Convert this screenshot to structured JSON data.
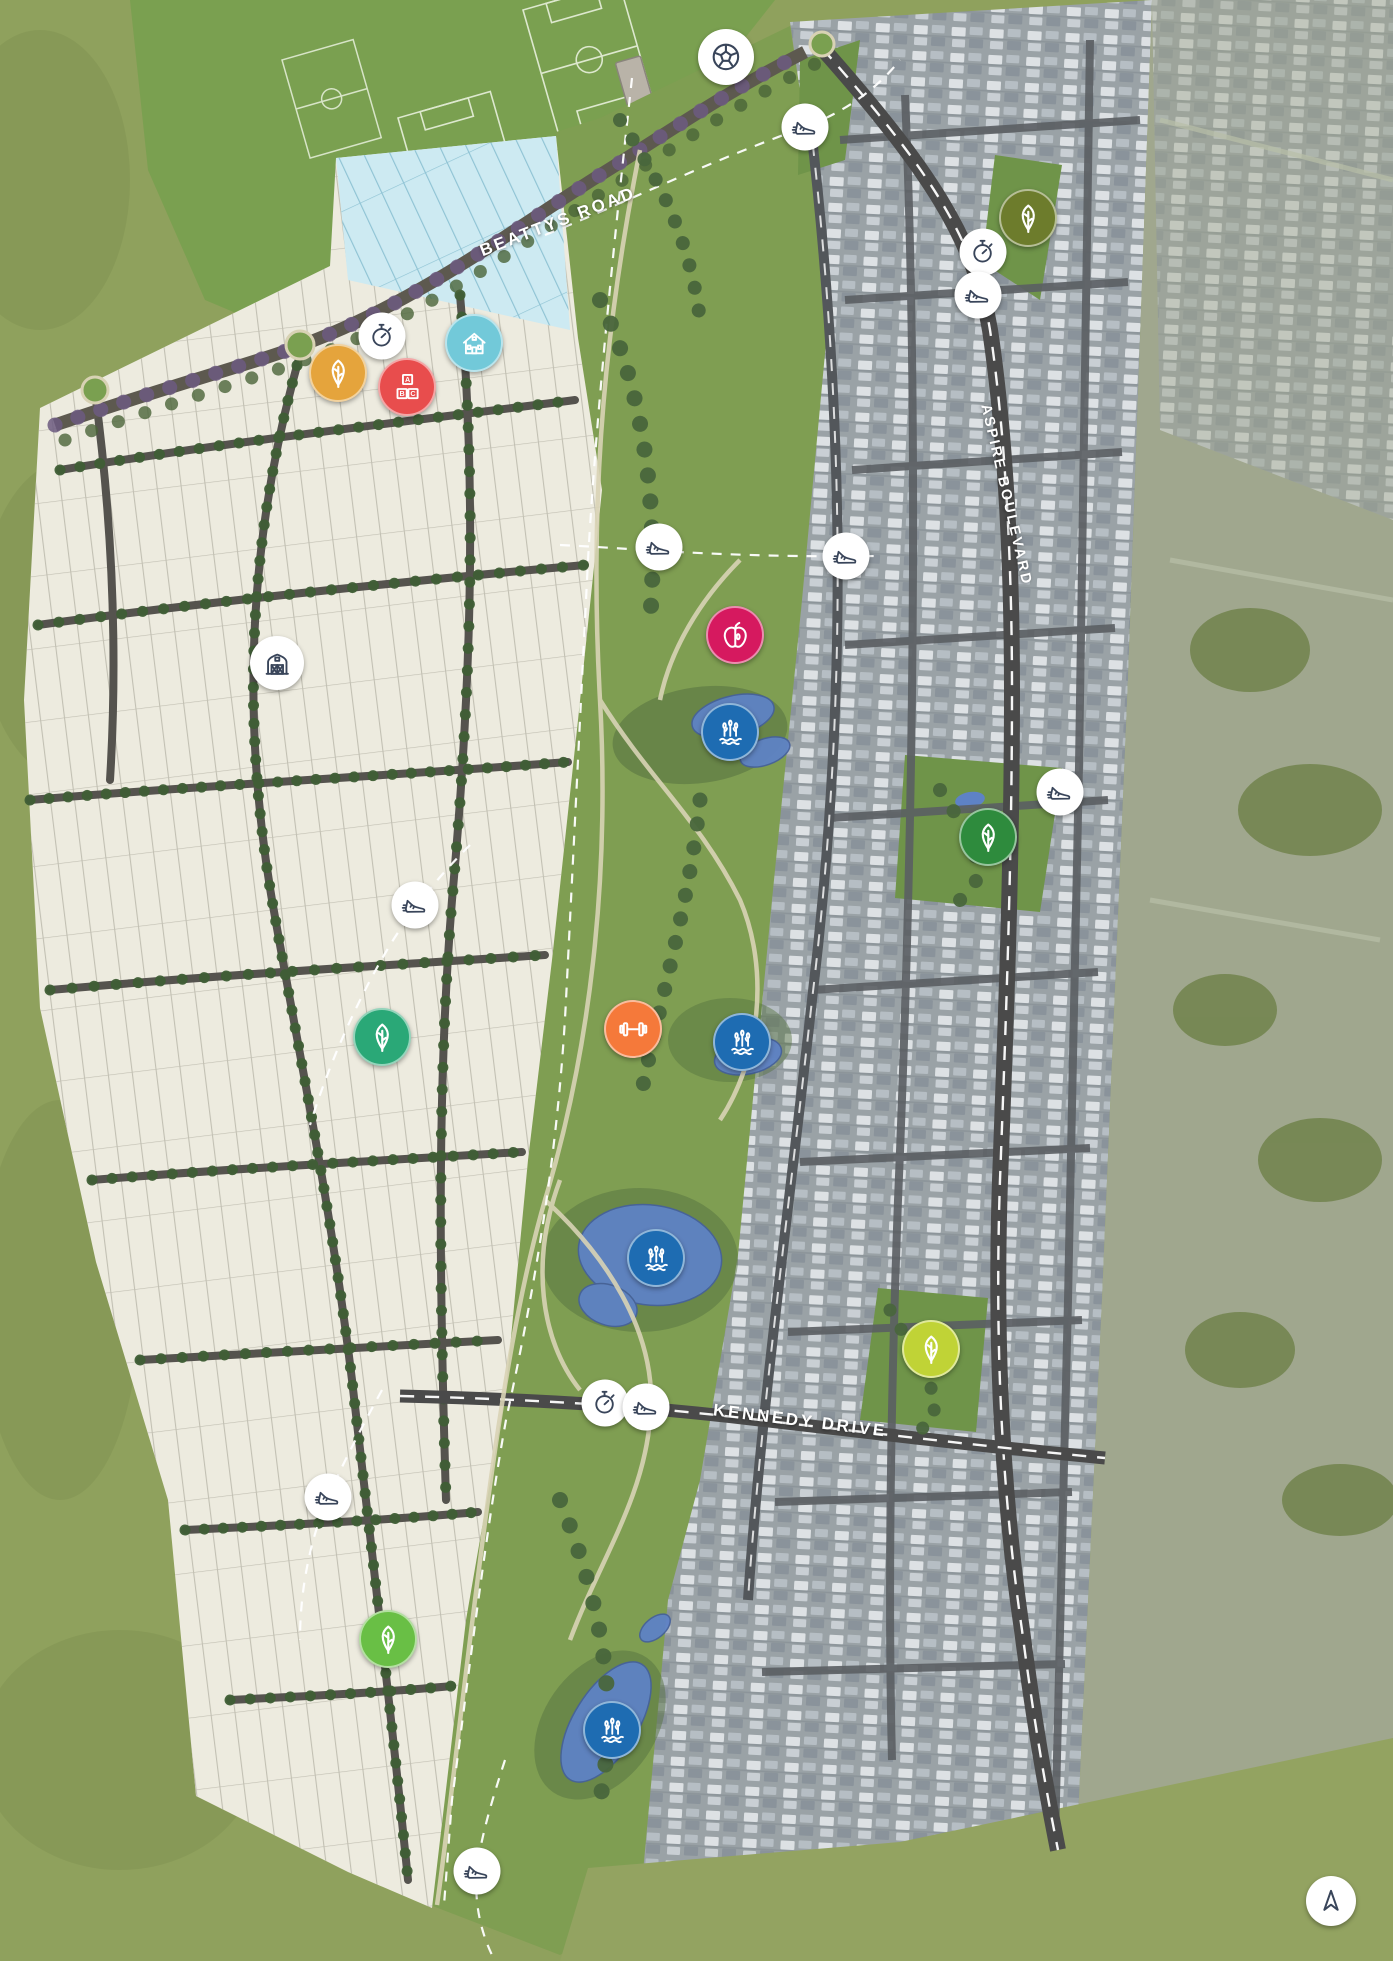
{
  "map": {
    "title": "Estate masterplan aerial map",
    "roads": [
      {
        "id": "beattys-road",
        "label": "BEATTYS ROAD"
      },
      {
        "id": "aspire-boulevard",
        "label": "ASPIRE BOULEVARD"
      },
      {
        "id": "kennedy-drive",
        "label": "KENNEDY DRIVE"
      }
    ],
    "colors": {
      "field_green": "#8fa15d",
      "parkland_green": "#7aa050",
      "corridor_green": "#7f9e52",
      "lot_white": "#edebdf",
      "display_lot_blue": "#cdeaf2",
      "pond_blue": "#5e82c6",
      "road_dark": "#4a4a4a",
      "marker_amber": "#e5a43c",
      "marker_red": "#e84d4d",
      "marker_teal_house": "#72c9d9",
      "marker_magenta": "#d6195f",
      "marker_wetland_blue": "#1e6cb2",
      "marker_orange": "#f5793a",
      "marker_olive": "#6d7c2c",
      "marker_green": "#2e8b3d",
      "marker_teal_leaf": "#2aa877",
      "marker_lime": "#c0d336",
      "marker_bright_green": "#69bf45",
      "marker_white": "#ffffff",
      "marker_glyph_dark": "#39455a"
    },
    "markers": [
      {
        "type": "soccer-ball",
        "x": 726,
        "y": 57,
        "size": 56,
        "bg": "#ffffff",
        "fg": "#39455a"
      },
      {
        "type": "running-shoe",
        "x": 805,
        "y": 127,
        "size": 47,
        "bg": "#ffffff",
        "fg": "#39455a"
      },
      {
        "type": "leaf",
        "x": 1028,
        "y": 218,
        "size": 54,
        "bg": "#6d7c2c",
        "fg": "#ffffff"
      },
      {
        "type": "stopwatch",
        "x": 983,
        "y": 252,
        "size": 47,
        "bg": "#ffffff",
        "fg": "#39455a"
      },
      {
        "type": "running-shoe",
        "x": 978,
        "y": 295,
        "size": 47,
        "bg": "#ffffff",
        "fg": "#39455a"
      },
      {
        "type": "stopwatch",
        "x": 382,
        "y": 336,
        "size": 47,
        "bg": "#ffffff",
        "fg": "#39455a"
      },
      {
        "type": "leaf",
        "x": 338,
        "y": 373,
        "size": 54,
        "bg": "#e5a43c",
        "fg": "#ffffff"
      },
      {
        "type": "house",
        "x": 474,
        "y": 343,
        "size": 54,
        "bg": "#72c9d9",
        "fg": "#ffffff"
      },
      {
        "type": "abc-blocks",
        "x": 407,
        "y": 387,
        "size": 54,
        "bg": "#e84d4d",
        "fg": "#ffffff"
      },
      {
        "type": "barn",
        "x": 277,
        "y": 663,
        "size": 54,
        "bg": "#ffffff",
        "fg": "#39455a"
      },
      {
        "type": "running-shoe",
        "x": 659,
        "y": 547,
        "size": 47,
        "bg": "#ffffff",
        "fg": "#39455a"
      },
      {
        "type": "running-shoe",
        "x": 846,
        "y": 556,
        "size": 47,
        "bg": "#ffffff",
        "fg": "#39455a"
      },
      {
        "type": "apple",
        "x": 735,
        "y": 635,
        "size": 54,
        "bg": "#d6195f",
        "fg": "#ffffff"
      },
      {
        "type": "wetland-reeds",
        "x": 730,
        "y": 732,
        "size": 54,
        "bg": "#1e6cb2",
        "fg": "#ffffff"
      },
      {
        "type": "running-shoe",
        "x": 1060,
        "y": 792,
        "size": 47,
        "bg": "#ffffff",
        "fg": "#39455a"
      },
      {
        "type": "leaf",
        "x": 988,
        "y": 837,
        "size": 54,
        "bg": "#2e8b3d",
        "fg": "#ffffff"
      },
      {
        "type": "running-shoe",
        "x": 415,
        "y": 905,
        "size": 47,
        "bg": "#ffffff",
        "fg": "#39455a"
      },
      {
        "type": "leaf",
        "x": 382,
        "y": 1037,
        "size": 54,
        "bg": "#2aa877",
        "fg": "#ffffff"
      },
      {
        "type": "dumbbell",
        "x": 633,
        "y": 1029,
        "size": 54,
        "bg": "#f5793a",
        "fg": "#ffffff"
      },
      {
        "type": "wetland-reeds",
        "x": 742,
        "y": 1042,
        "size": 54,
        "bg": "#1e6cb2",
        "fg": "#ffffff"
      },
      {
        "type": "wetland-reeds",
        "x": 656,
        "y": 1258,
        "size": 54,
        "bg": "#1e6cb2",
        "fg": "#ffffff"
      },
      {
        "type": "leaf",
        "x": 931,
        "y": 1349,
        "size": 54,
        "bg": "#c0d336",
        "fg": "#ffffff"
      },
      {
        "type": "stopwatch",
        "x": 605,
        "y": 1403,
        "size": 47,
        "bg": "#ffffff",
        "fg": "#39455a"
      },
      {
        "type": "running-shoe",
        "x": 646,
        "y": 1407,
        "size": 47,
        "bg": "#ffffff",
        "fg": "#39455a"
      },
      {
        "type": "running-shoe",
        "x": 328,
        "y": 1497,
        "size": 47,
        "bg": "#ffffff",
        "fg": "#39455a"
      },
      {
        "type": "leaf",
        "x": 388,
        "y": 1639,
        "size": 54,
        "bg": "#69bf45",
        "fg": "#ffffff"
      },
      {
        "type": "wetland-reeds",
        "x": 612,
        "y": 1730,
        "size": 54,
        "bg": "#1e6cb2",
        "fg": "#ffffff"
      },
      {
        "type": "running-shoe",
        "x": 477,
        "y": 1871,
        "size": 47,
        "bg": "#ffffff",
        "fg": "#39455a"
      },
      {
        "type": "north-arrow",
        "x": 1331,
        "y": 1901,
        "size": 50,
        "bg": "#ffffff",
        "fg": "#39455a"
      }
    ]
  }
}
